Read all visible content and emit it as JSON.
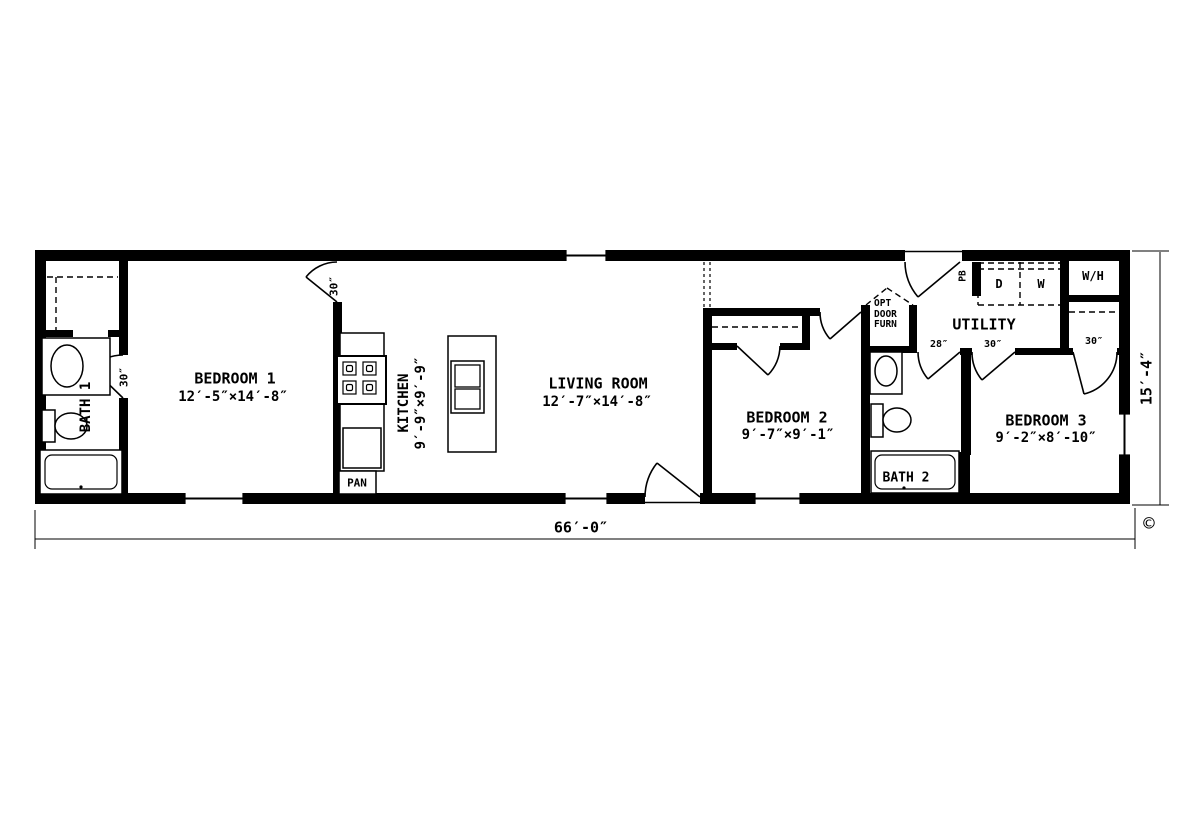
{
  "plan": {
    "rooms": {
      "bedroom1": {
        "name": "BEDROOM 1",
        "dims": "12′-5″×14′-8″"
      },
      "kitchen": {
        "name": "KITCHEN",
        "dims": "9′-9″×9′-9″"
      },
      "living": {
        "name": "LIVING ROOM",
        "dims": "12′-7″×14′-8″"
      },
      "bedroom2": {
        "name": "BEDROOM 2",
        "dims": "9′-7″×9′-1″"
      },
      "bedroom3": {
        "name": "BEDROOM 3",
        "dims": "9′-2″×8′-10″"
      },
      "bath1": {
        "name": "BATH 1"
      },
      "bath2": {
        "name": "BATH 2"
      },
      "utility": {
        "name": "UTILITY"
      }
    },
    "closets": {
      "furnace": [
        "OPT",
        "DOOR",
        "FURN"
      ]
    },
    "appliances": {
      "pantry": "PAN",
      "water_heater": "W/H",
      "dryer": "D",
      "washer": "W",
      "panel_box": "PB"
    },
    "door_sizes": {
      "bath1_door": "30″",
      "bedroom1_door": "30″",
      "bath2_door": "28″",
      "bedroom3_door": "30″",
      "bedroom3_closet_door": "30″"
    },
    "dimensions": {
      "overall_width": "66′-0″",
      "overall_depth": "15′-4″"
    },
    "copyright_symbol": "©"
  }
}
